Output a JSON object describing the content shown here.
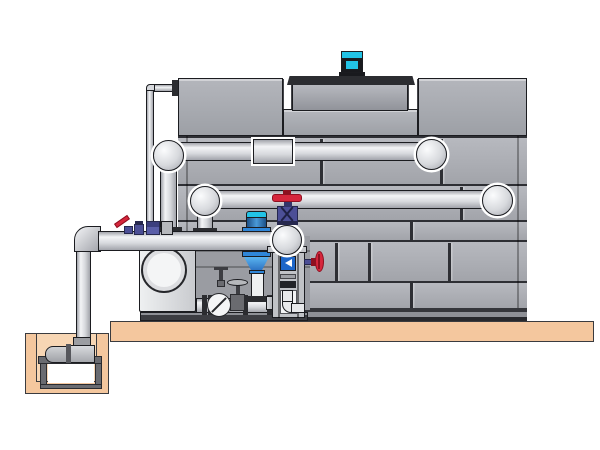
{
  "meta": {
    "subject": "Technical illustration: closed-circuit cooling tower with fan motor, pump skid, valves, riser piping and sump-pit pump on a concrete platform",
    "canvas_width": 600,
    "canvas_height": 450
  },
  "palette": {
    "bg": "#ffffff",
    "outline": "#1b1c20",
    "seam": "#2e2f34",
    "panel": "#a2a4aa",
    "panel-light": "#b7b9bf",
    "panel-dark": "#8e9096",
    "deck-dark": "#2c2d31",
    "pipe-hi": "#f3f4f6",
    "pipe-mid": "#d7d9dd",
    "pipe-shadow": "#a2a4ab",
    "platform-tan": "#f4c79e",
    "pit-tan": "#f7d6b4",
    "stand-gray": "#6a6b70",
    "motor-cyan": "#22c3e6",
    "motor-dark": "#191a1e",
    "valve-red": "#d6263c",
    "valve-red-dark": "#8e1020",
    "valve-purple": "#4c4f96",
    "valve-purple-dark": "#26284e",
    "pump-blue": "#2f86d8",
    "pump-blue-light": "#5ab4f0",
    "steel": "#b6b8bc",
    "steel-dark": "#56575c",
    "backdrop": "#9a9ca2",
    "white": "#f4f5f6"
  },
  "components": [
    "cooling-tower",
    "fan-motor",
    "fan-shroud",
    "fan-deck",
    "tower-panels",
    "hot-water-supply-pipe",
    "return-pipe",
    "make-up-line",
    "discharge-header",
    "end-suction-pump",
    "vertical-inline-pump",
    "globe-valve",
    "gate-valve",
    "check-valve",
    "lever-ball-valve",
    "solenoid-valves",
    "filter-column",
    "side-handwheel-valve",
    "sump-pit",
    "sump-pump",
    "pump-stand",
    "riser-pipe",
    "concrete-platform",
    "skid-base"
  ]
}
